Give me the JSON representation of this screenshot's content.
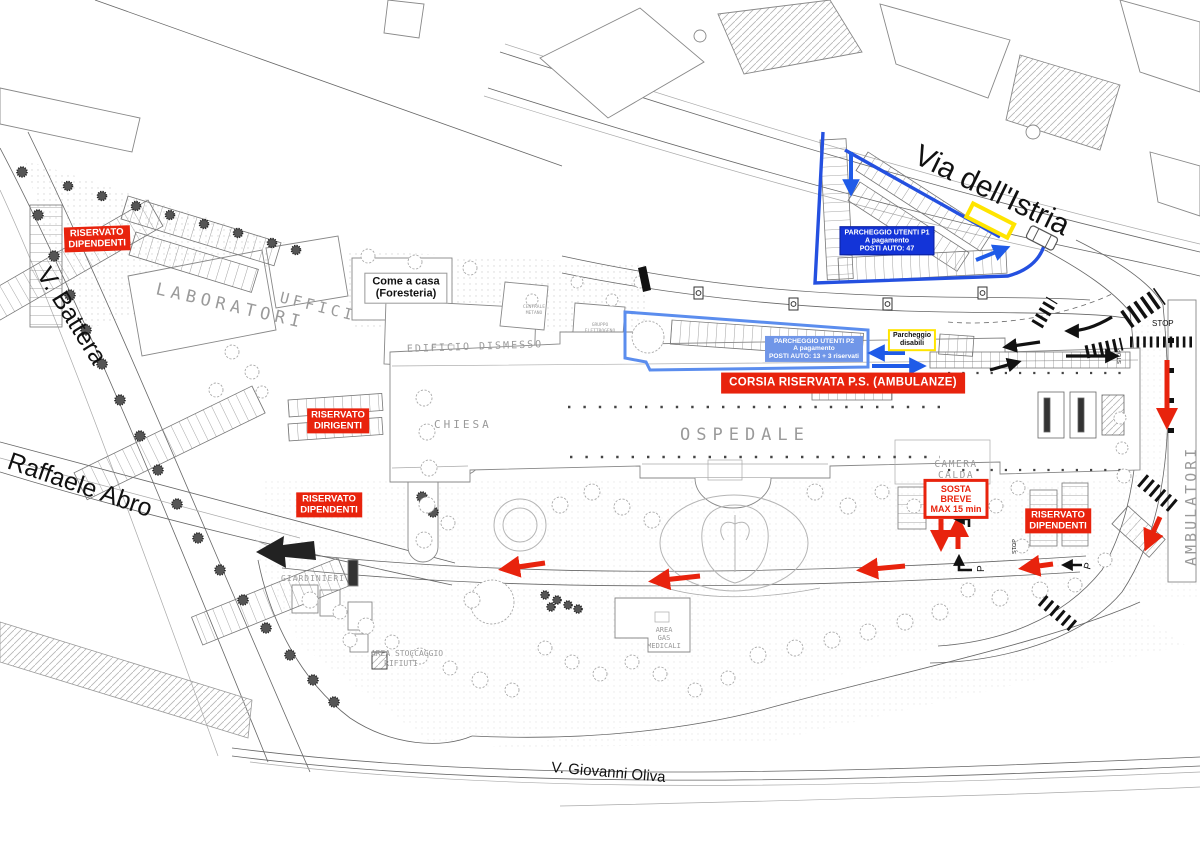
{
  "map": {
    "streets": {
      "via_istria": "Via dell'Istria",
      "v_battera": "V. Battera",
      "raffaele_abro": "Raffaele Abro",
      "v_giovanni_oliva": "V. Giovanni Oliva"
    },
    "buildings": {
      "laboratori": "LABORATORI",
      "uffici": "UFFICI",
      "edificio_dismesso": "EDIFICIO DISMESSO",
      "chiesa": "CHIESA",
      "ospedale": "OSPEDALE",
      "camera_calda_1": "CAMERA",
      "camera_calda_2": "CALDA",
      "giardinieri": "GIARDINIERI",
      "area_stoccaggio_1": "AREA STOCCAGGIO",
      "area_stoccaggio_2": "RIFIUTI",
      "area_gas_1": "AREA",
      "area_gas_2": "GAS",
      "area_gas_3": "MEDICALI",
      "ambulatori": "AMBULATORI",
      "centrale_metano_1": "CENTRALE",
      "centrale_metano_2": "METANO",
      "gruppo_elettrogeno_1": "GRUPPO",
      "gruppo_elettrogeno_2": "ELETTROGENO"
    },
    "signs": {
      "riservato_dipendenti": {
        "line1": "RISERVATO",
        "line2": "DIPENDENTI"
      },
      "riservato_dirigenti": {
        "line1": "RISERVATO",
        "line2": "DIRIGENTI"
      },
      "come_a_casa": {
        "line1": "Come a casa",
        "line2": "(Foresteria)"
      },
      "corsia_ambulanze": "CORSIA RISERVATA P.S. (AMBULANZE)",
      "parcheggio_p1": {
        "line1": "PARCHEGGIO UTENTI P1",
        "line2": "A pagamento",
        "line3": "POSTI AUTO: 47"
      },
      "parcheggio_p2": {
        "line1": "PARCHEGGIO UTENTI P2",
        "line2": "A pagamento",
        "line3": "POSTI AUTO:  13 + 3 riservati"
      },
      "parcheggio_disabili": {
        "line1": "Parcheggio",
        "line2": "disabili"
      },
      "sosta_breve": {
        "line1": "SOSTA",
        "line2": "BREVE",
        "line3": "MAX 15 min"
      },
      "stop": "STOP",
      "parking_marker": "P"
    },
    "colors": {
      "reserved_red": "#e8230d",
      "p1_blue": "#1334d8",
      "p2_blue": "#7096e8",
      "p1_outline_blue": "#2450e0",
      "p2_outline_blue": "#5b8dee",
      "disabled_yellow": "#ffe400",
      "arrow_red": "#e8230d",
      "arrow_blue": "#1f5be8",
      "arrow_black": "#111111"
    }
  }
}
